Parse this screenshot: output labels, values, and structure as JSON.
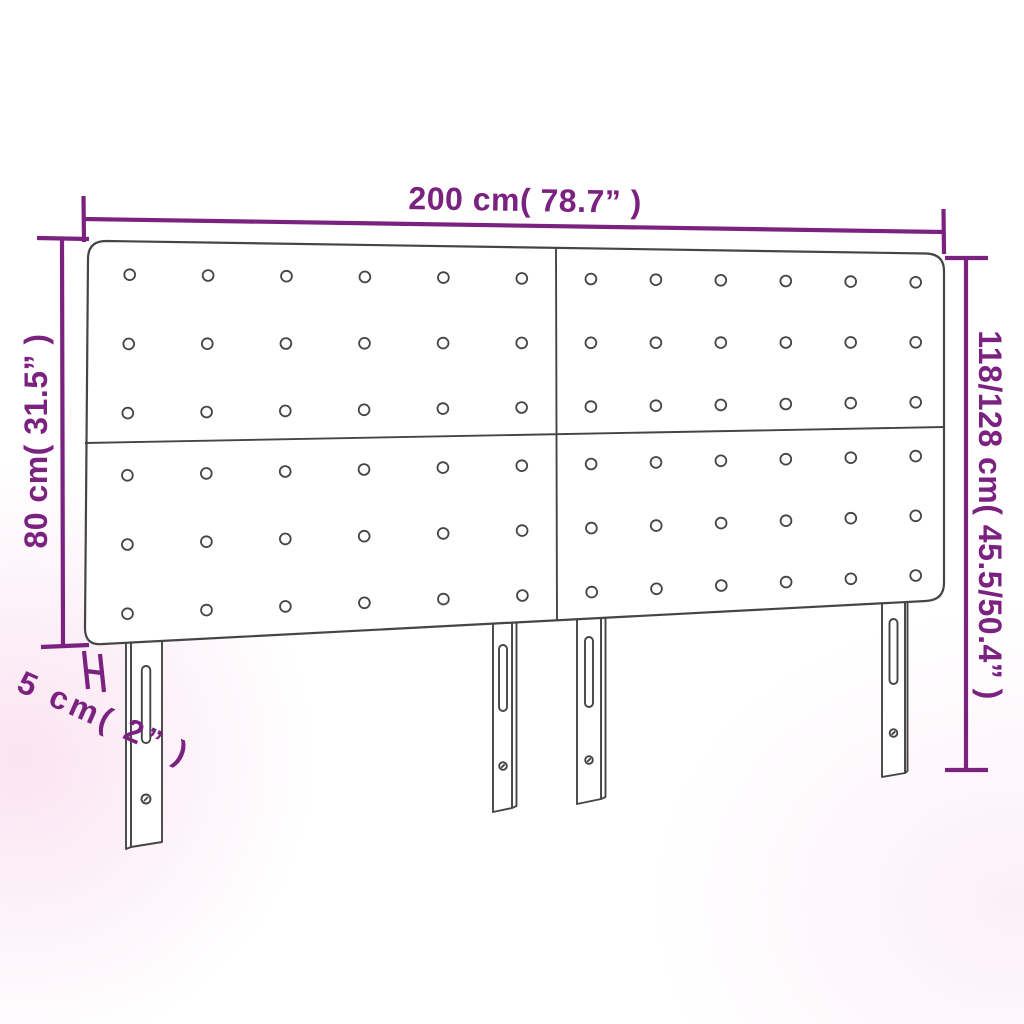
{
  "diagram": {
    "title": "headboard-dimension-diagram",
    "accent_color": "#7b2180",
    "line_color": "#454545",
    "dimensions": {
      "width_label": "200 cm( 78.7” )",
      "panel_height_label": "80 cm( 31.5” )",
      "total_height_label": "118/128 cm( 45.5/50.4” )",
      "depth_label": "5 cm( 2” )"
    },
    "structure": {
      "panels": 4,
      "button_rows_per_panel": 3,
      "button_cols_per_panel": 6,
      "legs": 4
    }
  }
}
